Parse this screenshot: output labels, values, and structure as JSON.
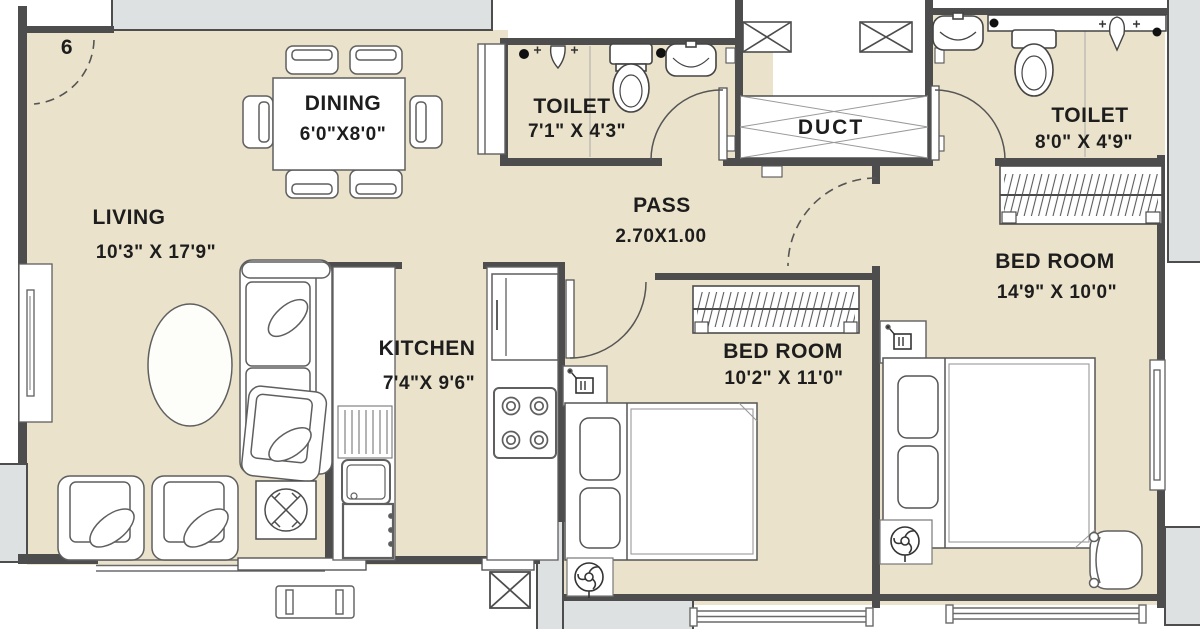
{
  "unit_number": "6",
  "rooms": {
    "living": {
      "label": "LIVING",
      "dims": "10'3\" X 17'9\""
    },
    "dining": {
      "label": "DINING",
      "dims": "6'0\"X8'0\""
    },
    "kitchen": {
      "label": "KITCHEN",
      "dims": "7'4\"X 9'6\""
    },
    "toilet_1": {
      "label": "TOILET",
      "dims": "7'1\" X 4'3\""
    },
    "toilet_2": {
      "label": "TOILET",
      "dims": "8'0\" X 4'9\""
    },
    "pass": {
      "label": "PASS",
      "dims": "2.70X1.00"
    },
    "duct": {
      "label": "DUCT"
    },
    "bedroom_1": {
      "label": "BED ROOM",
      "dims": "10'2\" X 11'0\""
    },
    "bedroom_2": {
      "label": "BED ROOM",
      "dims": "14'9\" X 10'0\""
    }
  },
  "colors": {
    "background": "#ffffff",
    "floor": "#eae2ca",
    "wall": "#4d4d4d",
    "slab": "#dee1e2",
    "furniture_outline": "#5f5f5f",
    "text": "#1d1d1d"
  }
}
